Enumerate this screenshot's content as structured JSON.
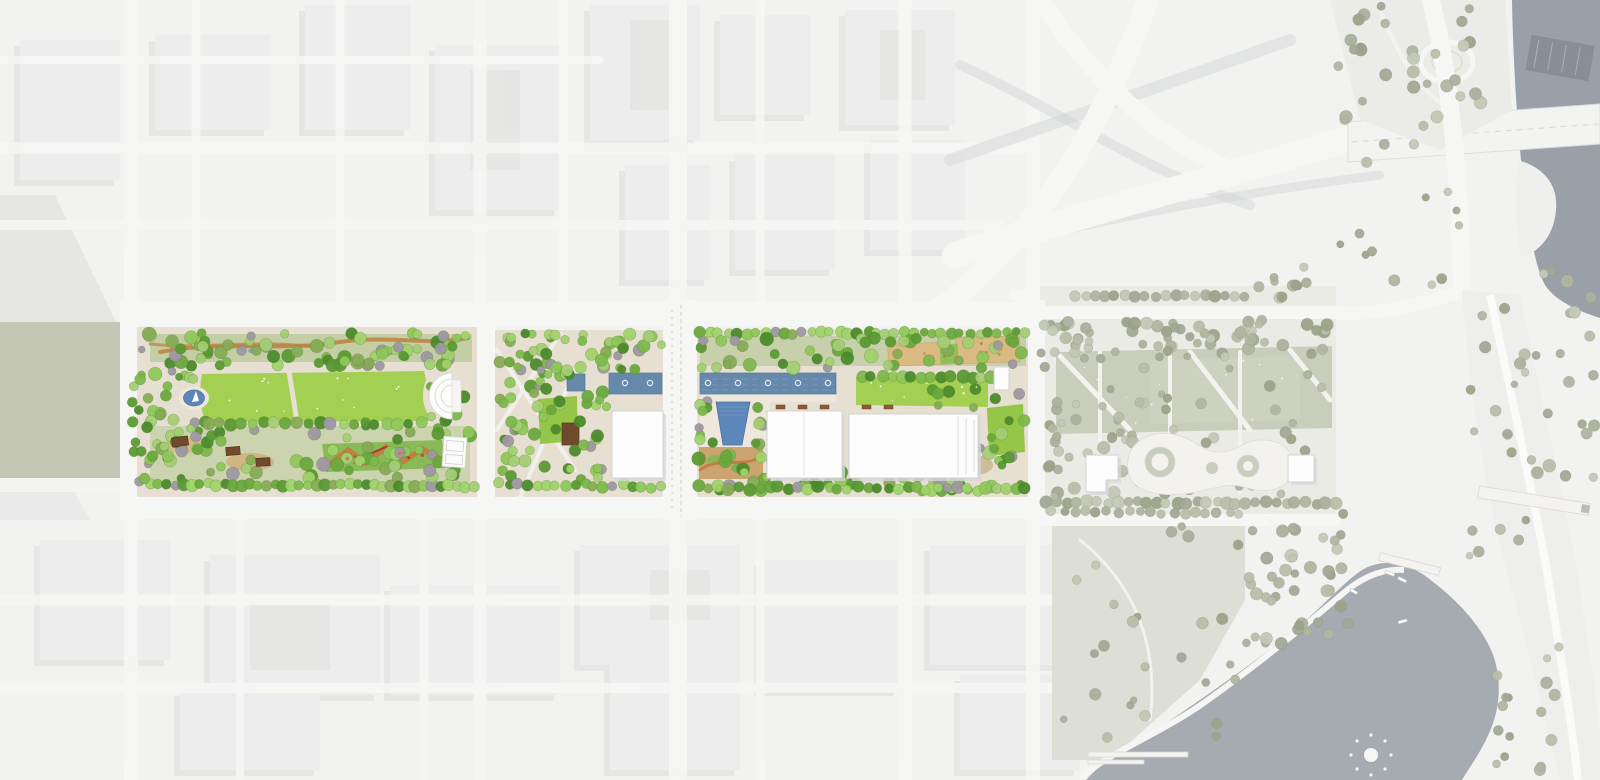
{
  "meta": {
    "title": "Aerial master plan rendering of a downtown linear park and riverfront",
    "description": "Bird's-eye site plan: a three-block linear park with lawns, canals, gardens and pavilions set in a faded city aerial, connecting to a muted existing riverfront park with looping promenade, a lake with fountain, a river and a highway interchange"
  },
  "features": [
    {
      "name": "city-fabric",
      "kind": "faded aerial context"
    },
    {
      "name": "park-west-block",
      "kind": "great lawn, pond, amphitheater, gardens, pavilions, court"
    },
    {
      "name": "park-center-block",
      "kind": "tree bosque, water plaza, lawn, canal, building"
    },
    {
      "name": "park-east-block",
      "kind": "canal with fountains, plunge pool, two halls, playgrounds, lawns"
    },
    {
      "name": "existing-riverfront-park",
      "kind": "muted tree rows, sage lawns, looping promenade, two buildings"
    },
    {
      "name": "lake",
      "kind": "gray water with fountain, marina, piers"
    },
    {
      "name": "river",
      "kind": "gray water, barge, highway bridge"
    },
    {
      "name": "highway-interchange",
      "kind": "sweeping faded ramps"
    }
  ],
  "palette": {
    "base": "#f2f2f1",
    "block": "#ededec",
    "shadow": "#d8d8da",
    "road": "#f6f6f4",
    "grayroad": "#d3d5d6",
    "paving": "#e8dfd3",
    "paving2": "#efe7db",
    "lawn": "#a3d052",
    "lawn2": "#96c649",
    "canal": "#6588ab",
    "pond": "#5d87bb",
    "river": "#9aa0a8",
    "lake": "#a6abb1",
    "sage": "#c9cdbb",
    "sagefield": "#c3c7b4",
    "groundd": "#ebebe6",
    "bank": "#eeefed",
    "bldg": "#fdfdfd",
    "tan": "#d9ba80",
    "orange": "#c08040"
  },
  "tree_layers": [
    {
      "group": "trees-muted",
      "seed": 11,
      "item": "tree-muted",
      "palette": [
        "#aab09c",
        "#b8bda9",
        "#9ca389",
        "#c3c7b5",
        "#a2a896",
        "#b0b5a1"
      ],
      "stroke": "#8a9079",
      "opacity": 0.95,
      "specs": [
        {
          "row": 1,
          "x0": 1075,
          "x1": 1245,
          "y0": 296,
          "y1": 296,
          "n": 18,
          "r0": 4.5,
          "r1": 6,
          "jy": 2
        },
        {
          "x0": 1252,
          "x1": 1325,
          "y0": 262,
          "y1": 300,
          "n": 10,
          "r0": 4,
          "r1": 6
        },
        {
          "x0": 1050,
          "x1": 1332,
          "y0": 320,
          "y1": 354,
          "n": 58,
          "r0": 4,
          "r1": 6.5
        },
        {
          "x0": 1058,
          "x1": 1332,
          "y0": 356,
          "y1": 432,
          "n": 26,
          "r0": 3.5,
          "r1": 6
        },
        {
          "x0": 1055,
          "x1": 1335,
          "y0": 432,
          "y1": 497,
          "n": 48,
          "r0": 4,
          "r1": 6.5
        },
        {
          "row": 1,
          "x0": 1048,
          "x1": 1335,
          "y0": 502,
          "y1": 503,
          "n": 30,
          "r0": 4.5,
          "r1": 6.5,
          "jy": 3
        },
        {
          "row": 1,
          "x0": 1052,
          "x1": 1240,
          "y0": 512,
          "y1": 513,
          "n": 18,
          "r0": 4,
          "r1": 5.5,
          "jy": 3
        },
        {
          "x0": 1040,
          "x1": 1058,
          "y0": 325,
          "y1": 500,
          "n": 12,
          "r0": 3.5,
          "r1": 5.5
        },
        {
          "x0": 1240,
          "x1": 1350,
          "y0": 512,
          "y1": 645,
          "n": 42,
          "r0": 4,
          "r1": 6.5
        },
        {
          "x0": 1060,
          "x1": 1240,
          "y0": 525,
          "y1": 745,
          "n": 26,
          "r0": 3.5,
          "r1": 6
        },
        {
          "x0": 1338,
          "x1": 1482,
          "y0": 4,
          "y1": 132,
          "n": 30,
          "r0": 4,
          "r1": 6.5
        },
        {
          "x0": 1460,
          "x1": 1530,
          "y0": 300,
          "y1": 560,
          "n": 18,
          "r0": 3.5,
          "r1": 6
        },
        {
          "x0": 1530,
          "x1": 1598,
          "y0": 260,
          "y1": 480,
          "n": 20,
          "r0": 4,
          "r1": 6.5
        },
        {
          "x0": 1495,
          "x1": 1560,
          "y0": 640,
          "y1": 772,
          "n": 16,
          "r0": 3.5,
          "r1": 6
        },
        {
          "x0": 1336,
          "x1": 1460,
          "y0": 140,
          "y1": 300,
          "n": 14,
          "r0": 3.5,
          "r1": 6
        }
      ]
    },
    {
      "group": "trees-bright",
      "seed": 7,
      "item": "tree",
      "palette": [
        "#6aa83d",
        "#7cb84b",
        "#8ec75a",
        "#9fd369",
        "#5a9a33",
        "#4c8a2c",
        "#a4ce74",
        "#87ab56",
        "#9e97a4"
      ],
      "stroke": "#4e7c2a",
      "opacity": 0.95,
      "specs": [
        {
          "x0": 146,
          "x1": 472,
          "y0": 333,
          "y1": 366,
          "n": 72,
          "r0": 4,
          "r1": 7
        },
        {
          "x0": 143,
          "x1": 176,
          "y0": 368,
          "y1": 475,
          "n": 16,
          "r0": 4,
          "r1": 7
        },
        {
          "x0": 176,
          "x1": 206,
          "y0": 418,
          "y1": 478,
          "n": 8,
          "r0": 4,
          "r1": 6.5
        },
        {
          "x0": 176,
          "x1": 206,
          "y0": 368,
          "y1": 382,
          "n": 4,
          "r0": 3.5,
          "r1": 5.5
        },
        {
          "x0": 148,
          "x1": 472,
          "y0": 424,
          "y1": 480,
          "n": 60,
          "r0": 4,
          "r1": 7
        },
        {
          "row": 1,
          "x0": 150,
          "x1": 474,
          "y0": 484,
          "y1": 486,
          "n": 40,
          "r0": 4.5,
          "r1": 6.5,
          "jx": 2,
          "jy": 3
        },
        {
          "x0": 424,
          "x1": 474,
          "y0": 336,
          "y1": 478,
          "n": 20,
          "r0": 4,
          "r1": 6.5
        },
        {
          "row": 1,
          "x0": 208,
          "x1": 420,
          "y0": 424,
          "y1": 423,
          "n": 20,
          "r0": 4.5,
          "r1": 6.5,
          "jy": 4
        },
        {
          "x0": 131,
          "x1": 145,
          "y0": 333,
          "y1": 492,
          "n": 12,
          "r0": 3.5,
          "r1": 5.5
        },
        {
          "x0": 498,
          "x1": 578,
          "y0": 346,
          "y1": 478,
          "n": 56,
          "r0": 4,
          "r1": 6.5
        },
        {
          "x0": 580,
          "x1": 662,
          "y0": 333,
          "y1": 370,
          "n": 26,
          "r0": 4,
          "r1": 6.5
        },
        {
          "x0": 580,
          "x1": 610,
          "y0": 392,
          "y1": 480,
          "n": 16,
          "r0": 4,
          "r1": 6.5
        },
        {
          "row": 1,
          "x0": 500,
          "x1": 660,
          "y0": 485,
          "y1": 486,
          "n": 18,
          "r0": 4.5,
          "r1": 6
        },
        {
          "x0": 497,
          "x1": 578,
          "y0": 332,
          "y1": 344,
          "n": 10,
          "r0": 3.5,
          "r1": 5.5
        },
        {
          "row": 1,
          "x0": 700,
          "x1": 1026,
          "y0": 333,
          "y1": 333,
          "n": 36,
          "r0": 4,
          "r1": 6,
          "jy": 3
        },
        {
          "x0": 698,
          "x1": 1026,
          "y0": 338,
          "y1": 368,
          "n": 48,
          "r0": 4,
          "r1": 7
        },
        {
          "row": 1,
          "x0": 862,
          "x1": 992,
          "y0": 377,
          "y1": 377,
          "n": 14,
          "r0": 5,
          "r1": 7,
          "jy": 2
        },
        {
          "x0": 698,
          "x1": 714,
          "y0": 398,
          "y1": 446,
          "n": 8,
          "r0": 4,
          "r1": 6
        },
        {
          "x0": 752,
          "x1": 770,
          "y0": 398,
          "y1": 446,
          "n": 6,
          "r0": 4,
          "r1": 6
        },
        {
          "x0": 698,
          "x1": 1026,
          "y0": 444,
          "y1": 492,
          "n": 55,
          "r0": 4,
          "r1": 7
        },
        {
          "row": 1,
          "x0": 700,
          "x1": 1026,
          "y0": 488,
          "y1": 489,
          "n": 34,
          "r0": 4.5,
          "r1": 6.5
        },
        {
          "x0": 932,
          "x1": 1026,
          "y0": 388,
          "y1": 470,
          "n": 22,
          "r0": 4,
          "r1": 6.5
        }
      ]
    },
    {
      "group": "play-specks",
      "seed": 3,
      "item": "play-equipment",
      "palette": [
        "#b98c4d",
        "#a87c40",
        "#c29a5d"
      ],
      "opacity": 0.9,
      "specs": [
        {
          "x0": 892,
          "x1": 1016,
          "y0": 343,
          "y1": 362,
          "n": 10,
          "r0": 1,
          "r1": 2
        }
      ]
    },
    {
      "group": "garden-accents",
      "seed": 9,
      "item": "garden-accent",
      "palette": [
        "#c2512f",
        "#d56a3a"
      ],
      "opacity": 0.9,
      "specs": [
        {
          "x0": 334,
          "x1": 436,
          "y0": 446,
          "y1": 466,
          "n": 8,
          "r0": 1,
          "r1": 2
        }
      ]
    },
    {
      "group": "lawn-specks",
      "seed": 5,
      "item": "lawn-speck",
      "palette": [
        "#ffffff"
      ],
      "opacity": 0.85,
      "specs": [
        {
          "x0": 212,
          "x1": 418,
          "y0": 378,
          "y1": 416,
          "n": 14,
          "r0": 0.6,
          "r1": 1.1
        },
        {
          "x0": 862,
          "x1": 982,
          "y0": 381,
          "y1": 402,
          "n": 8,
          "r0": 0.6,
          "r1": 1.1
        },
        {
          "x0": 1080,
          "x1": 1300,
          "y0": 358,
          "y1": 424,
          "n": 12,
          "r0": 0.5,
          "r1": 1
        }
      ]
    }
  ]
}
